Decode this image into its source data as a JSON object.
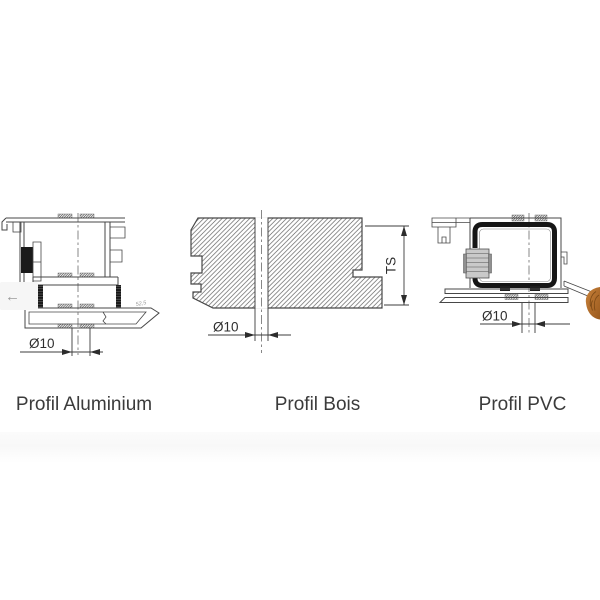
{
  "carousel": {
    "prev_icon": "←"
  },
  "slides": [
    {
      "label": "Profil Aluminium",
      "hole_dim": "Ø10",
      "angle_note": "52,5"
    },
    {
      "label": "Profil Bois",
      "hole_dim": "Ø10",
      "height_dim": "TS"
    },
    {
      "label": "Profil PVC",
      "hole_dim": "Ø10"
    }
  ],
  "colors": {
    "background": "#ffffff",
    "drawing_line": "#474747",
    "label_text": "#3b3b3b",
    "steel_reinforcement": "#161616",
    "gasket": "#1a1a1a",
    "fitting": "#c9c9c9",
    "wood_preview": "#b06e2c",
    "nav_background": "#f6f6f6",
    "nav_arrow": "#9a9a9a"
  }
}
